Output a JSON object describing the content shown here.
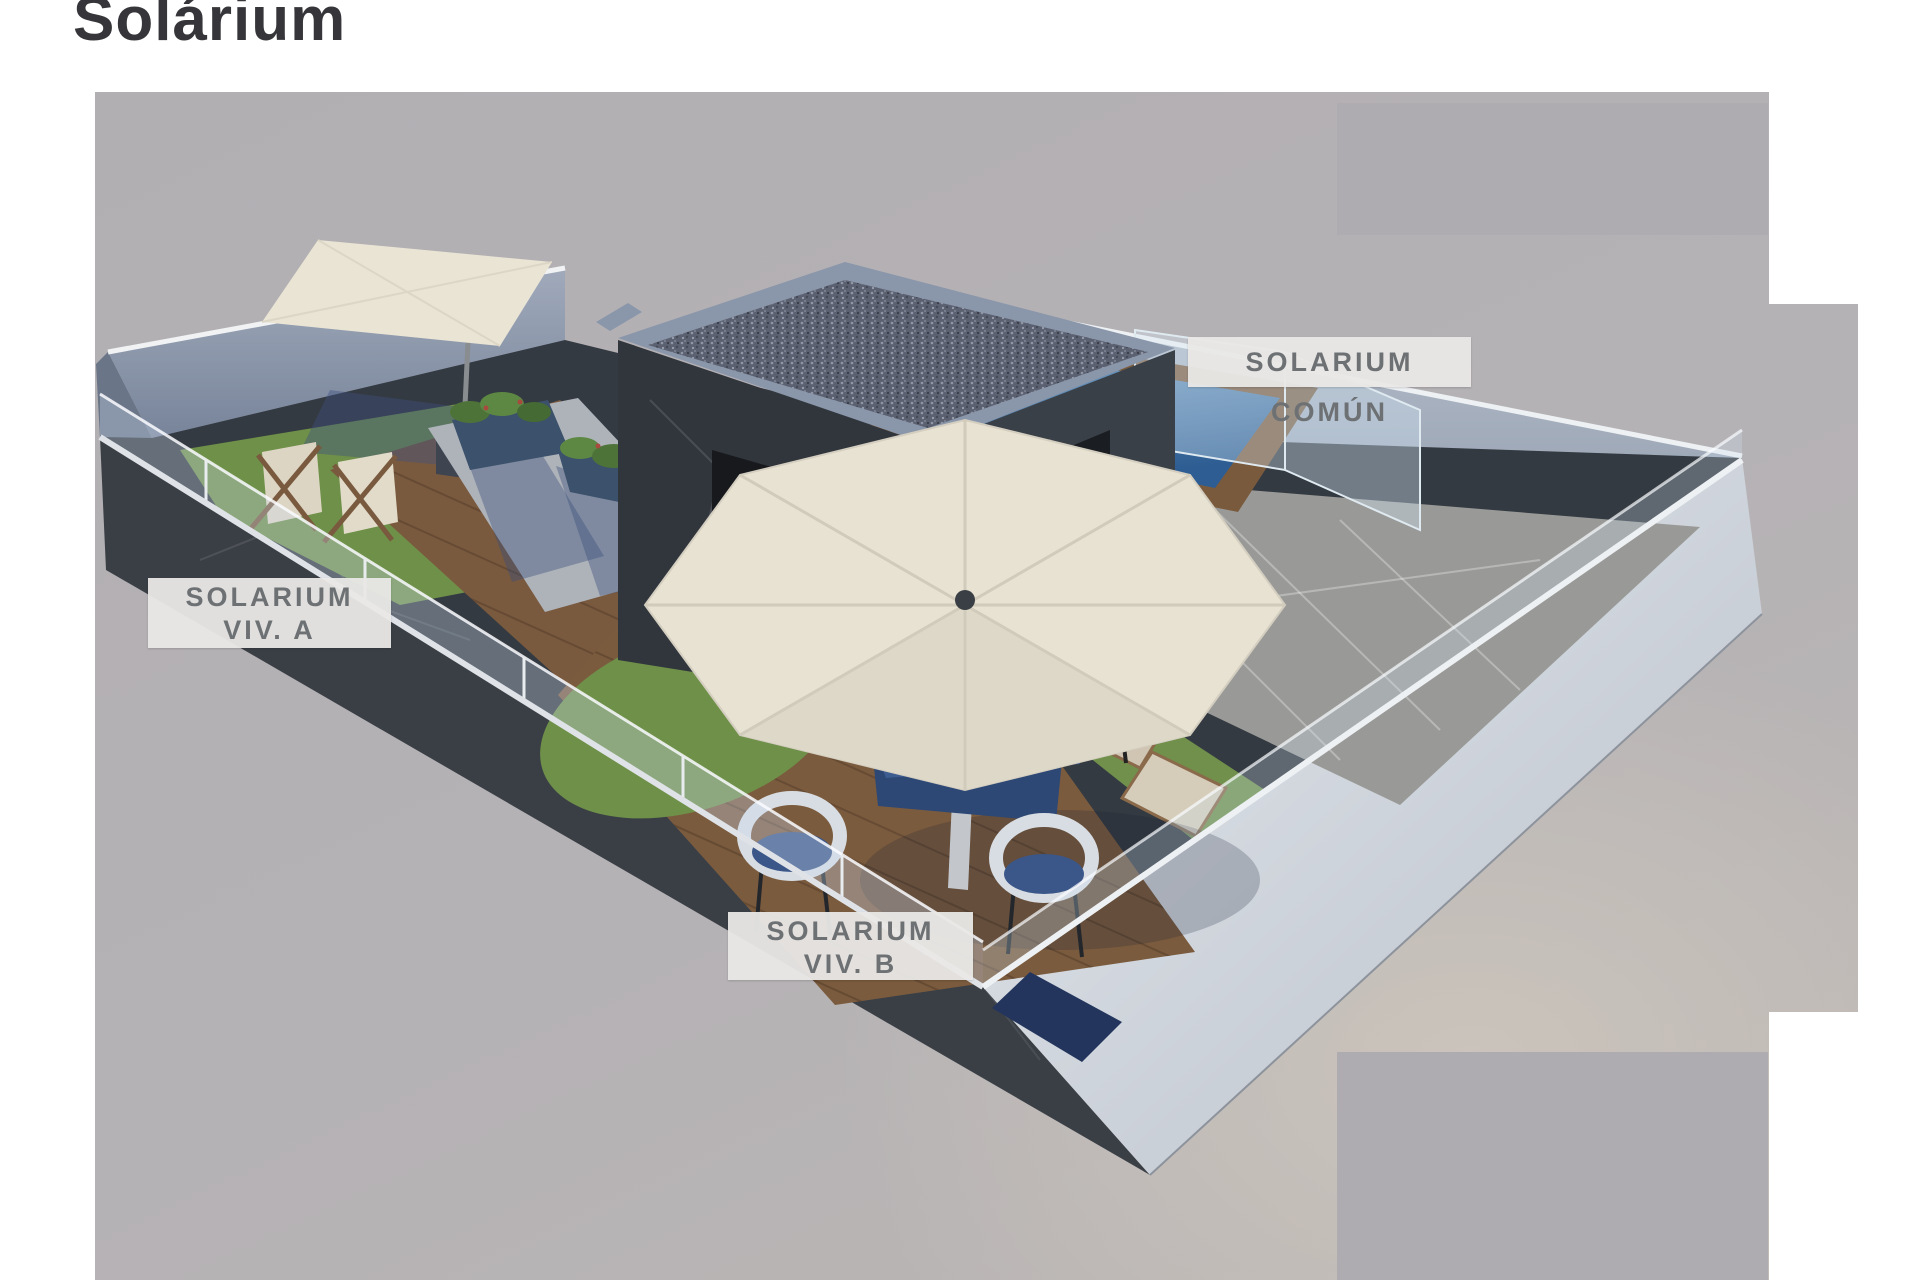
{
  "title": "Solárium",
  "render": {
    "labels": {
      "solarium_comun": "SOLARIUM COMÚN",
      "solarium_viv_a": {
        "line1": "SOLARIUM",
        "line2": "VIV. A"
      },
      "solarium_viv_b": {
        "line1": "SOLARIUM",
        "line2": "VIV. B"
      }
    },
    "colors": {
      "page_background": "#ffffff",
      "render_background_gray": "#b5b2b5",
      "ground_beige": "#cbc4bc",
      "cover_rectangle_gray": "#aeabb1",
      "label_background": "#e9e8e6",
      "label_text": "#6d7174",
      "title_text": "#36363a",
      "dark_marble_wall": "#383d44",
      "light_outer_wall": "#dfe3e8",
      "blue_gray_wall": "#98a3b4",
      "wood_deck": "#7a5a3e",
      "grass_green": "#6f9049",
      "pool_water_blue": "#3d6ea2",
      "umbrella_cream": "#e7e2d2",
      "dining_table_blue": "#3d5c90",
      "roof_gravel_gray": "#5f6573"
    }
  }
}
